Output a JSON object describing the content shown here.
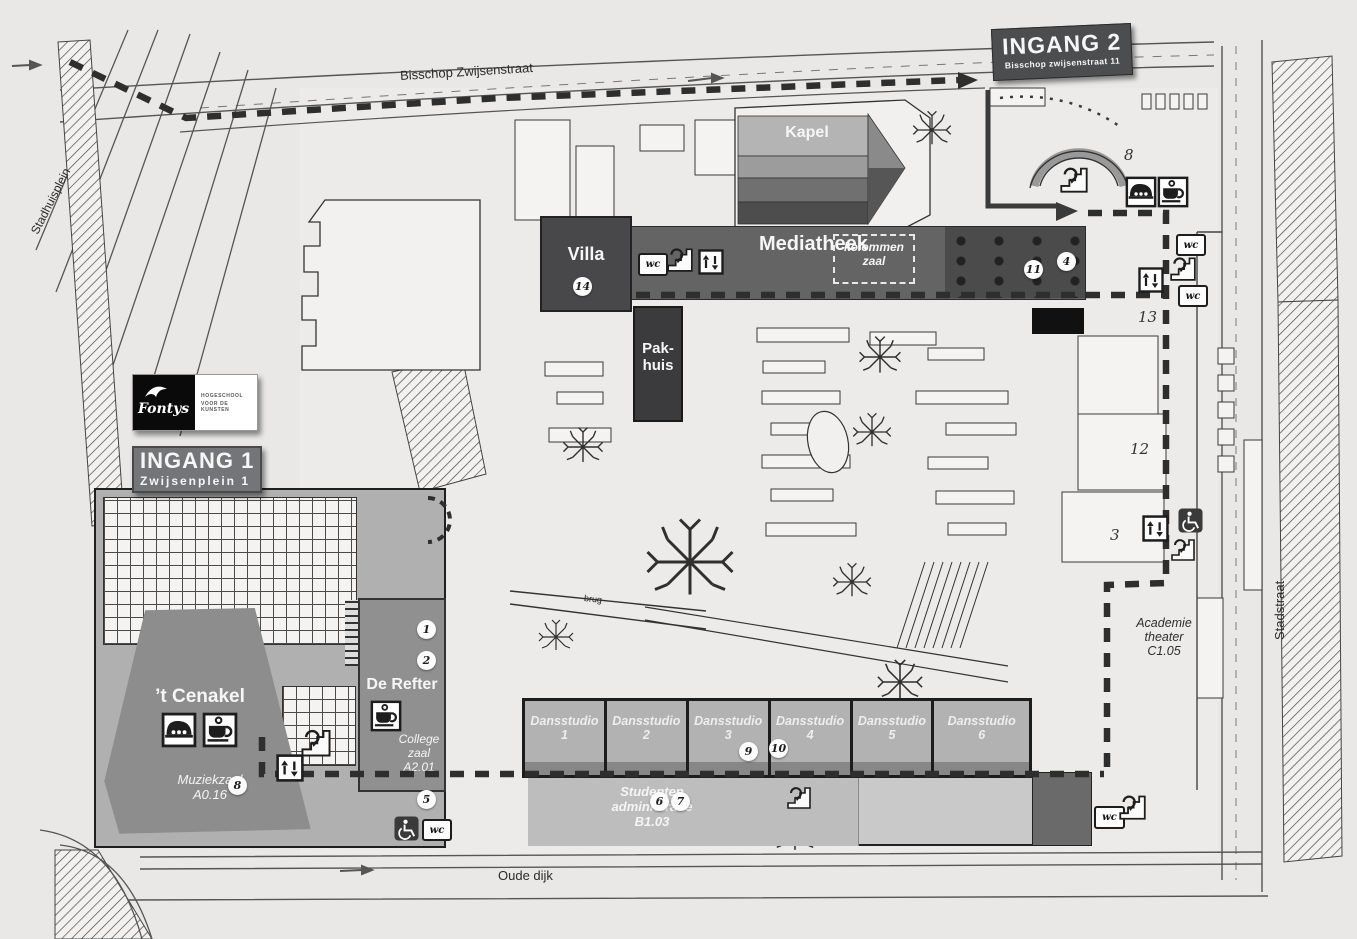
{
  "streets": {
    "top": "Bisschop Zwijsenstraat",
    "left": "Stadhuisplein",
    "right": "Stadstraat",
    "bottom": "Oude dijk",
    "bridge": "brug"
  },
  "entrance1": {
    "title": "INGANG 1",
    "subtitle": "Zwijsenplein 1"
  },
  "entrance2": {
    "title": "INGANG 2",
    "subtitle": "Bisschop zwijsenstraat 11"
  },
  "logo": {
    "brand": "Fontys",
    "tagline1": "HOGESCHOOL",
    "tagline2": "VOOR DE KUNSTEN"
  },
  "buildings": {
    "kapel": "Kapel",
    "mediatheek": "Mediatheek",
    "kolommen_line1": "kolommen",
    "kolommen_line2": "zaal",
    "villa": "Villa",
    "pakhuis_line1": "Pak-",
    "pakhuis_line2": "huis",
    "cenakel": "’t Cenakel",
    "muziekzaal_name": "Muziekzaal",
    "muziekzaal_room": "A0.16",
    "de_refter": "De Refter",
    "college_line1": "College",
    "college_line2": "zaal",
    "college_room": "A2.01",
    "studenten_line1": "Studenten",
    "studenten_line2": "administratie",
    "studenten_room": "B1.03",
    "academie_line1": "Academie",
    "academie_line2": "theater",
    "academie_room": "C1.05"
  },
  "studios": {
    "label": "Dansstudio",
    "numbers": [
      "1",
      "2",
      "3",
      "4",
      "5",
      "6"
    ]
  },
  "markers": {
    "m1": "1",
    "m2": "2",
    "m4": "4",
    "m5": "5",
    "m6": "6",
    "m7": "7",
    "m8": "8",
    "m9": "9",
    "m10": "10",
    "m11": "11",
    "m14": "14"
  },
  "area_numbers": {
    "n8": "8",
    "n13": "13",
    "n12": "12",
    "n3": "3"
  },
  "icons": {
    "wc": "wc"
  },
  "colors": {
    "route": "#2e2e2e",
    "dark_building": "#3b3b3d",
    "mid_building": "#646464",
    "banner": "#4c4d4f"
  }
}
